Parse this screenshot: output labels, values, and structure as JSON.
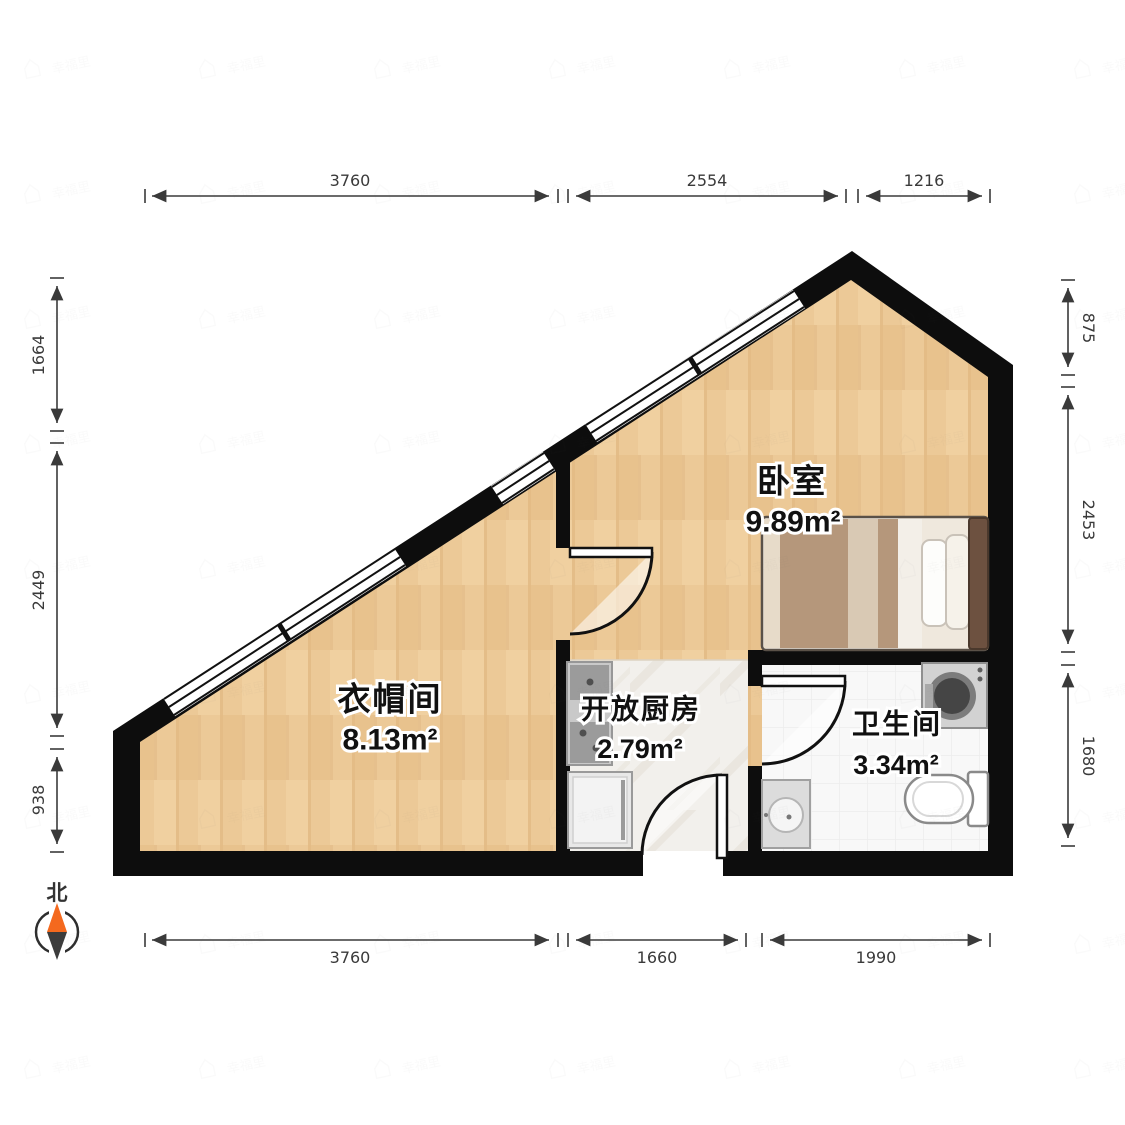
{
  "title": "户型图",
  "compass": {
    "label": "北"
  },
  "rooms": [
    {
      "id": "bedroom",
      "name": "卧室",
      "area": "9.89m²"
    },
    {
      "id": "cloakroom",
      "name": "衣帽间",
      "area": "8.13m²"
    },
    {
      "id": "kitchen",
      "name": "开放厨房",
      "area": "2.79m²"
    },
    {
      "id": "bathroom",
      "name": "卫生间",
      "area": "3.34m²"
    }
  ],
  "dimensions": {
    "top": [
      "3760",
      "2554",
      "1216"
    ],
    "bottom": [
      "3760",
      "1660",
      "1990"
    ],
    "left": [
      "1664",
      "2449",
      "938"
    ],
    "right": [
      "875",
      "2453",
      "1680"
    ]
  },
  "watermark": {
    "text": "幸福里"
  },
  "colors": {
    "wall": "#0d0d0d",
    "wood_floor": "#ecc997",
    "kitchen_floor": "#f2f0ec",
    "bath_floor": "#f8f8f8",
    "compass_orange": "#f4691e",
    "compass_dark": "#3c3c3c",
    "dimension": "#3a3a3a"
  }
}
